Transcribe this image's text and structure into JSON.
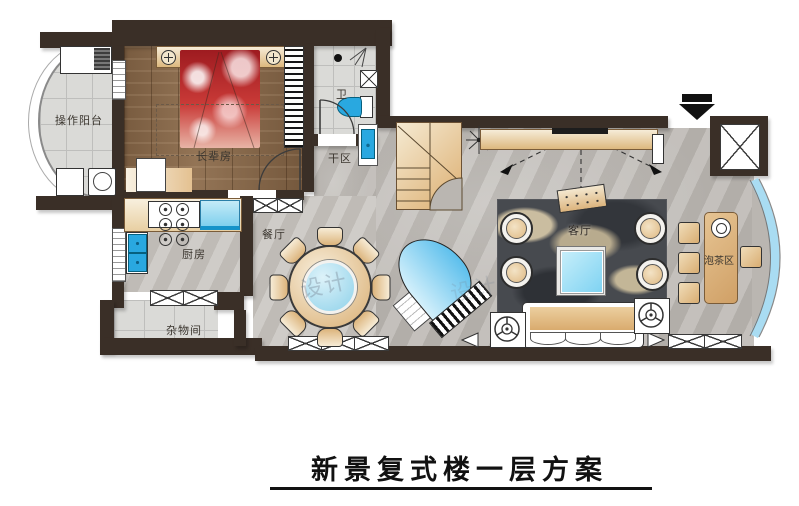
{
  "title": {
    "text": "新景复式楼一层方案"
  },
  "rooms": {
    "balcony": {
      "label": "操作阳台"
    },
    "bedroom": {
      "label": "长辈房"
    },
    "bathroom": {
      "label": "卫"
    },
    "dry_area": {
      "label": "干区"
    },
    "kitchen": {
      "label": "厨房"
    },
    "storage": {
      "label": "杂物间"
    },
    "dining": {
      "label": "餐厅"
    },
    "living": {
      "label": "客厅"
    },
    "tea_area": {
      "label": "泡茶区"
    }
  },
  "watermark": {
    "text": "设计"
  },
  "colors": {
    "wall": "#3a2f27",
    "marble_floor": "#bab6b1",
    "tile_floor": "#dadad7",
    "wood_floor": "#8a6a4b",
    "fixture_blue": "#29a8e0",
    "glass_blue": "#a9dcf2",
    "bed_red": "#bf2428",
    "furniture_tan": "#ddb87e",
    "rug_dark": "#474a4f"
  }
}
